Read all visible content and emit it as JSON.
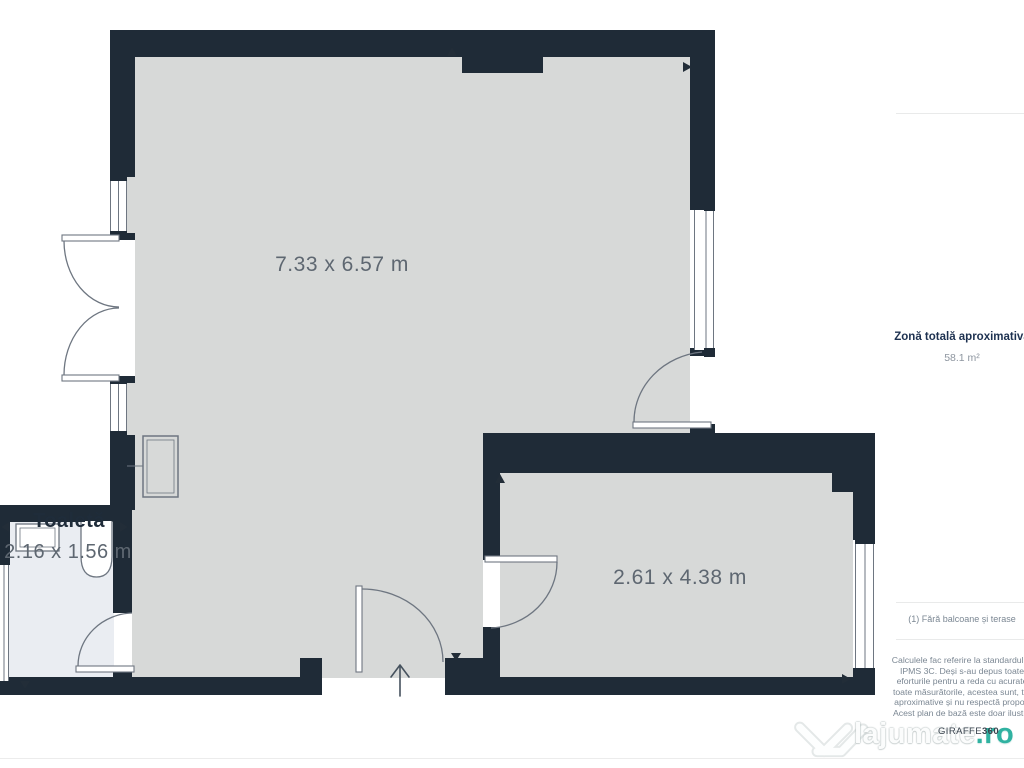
{
  "plan": {
    "rooms": [
      {
        "id": "main-room",
        "dims": "7.33 x 6.57 m"
      },
      {
        "id": "toilet",
        "name": "Toaletă",
        "dims": "2.16 x 1.56 m"
      },
      {
        "id": "second-room",
        "dims": "2.61 x 4.38 m"
      }
    ]
  },
  "sidebar": {
    "logo_icon": "giraffe360-logo",
    "total_area_label": "Zonă totală aproximativă",
    "total_area_value": "58.1 m²",
    "footnote": "(1) Fără balcoane și terase",
    "disclaimer_lines": [
      "Calculele fac referire la standardul R",
      "IPMS 3C. Deși s-au depus toate",
      "eforturile pentru a reda cu acurate",
      "toate măsurătorile, acestea sunt, tot",
      "aproximative și nu respectă proporț",
      "Acest plan de bază este doar ilustra"
    ],
    "brand_name": "GIRAFFE",
    "brand_number": "360"
  },
  "watermark": {
    "name": "lajumate",
    "tld": ".ro"
  },
  "colors": {
    "wall": "#1f2b37",
    "floor": "#d7d9d8",
    "toilet_floor": "#eaedf2",
    "logo_teal": "#18a7a7",
    "watermark_teal": "#30b2a1"
  }
}
